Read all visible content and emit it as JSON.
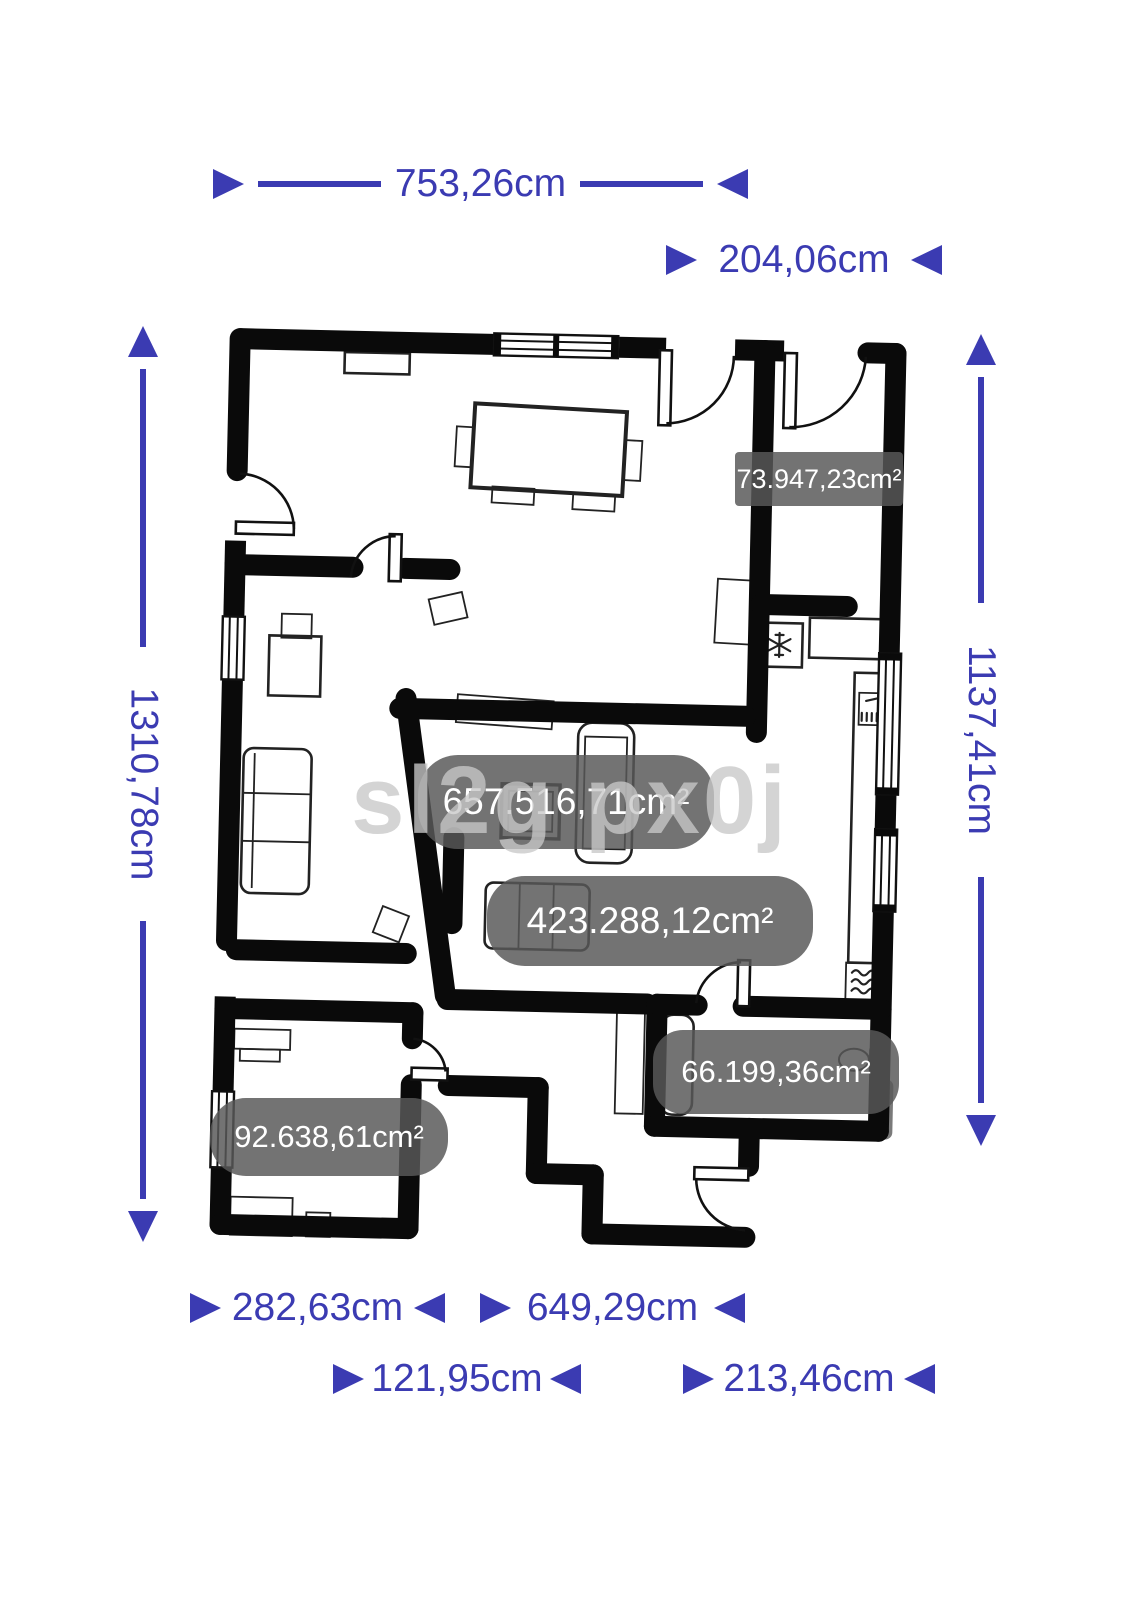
{
  "colors": {
    "dimension_blue": "#3B3BB2",
    "wall_black": "#0A0A0A",
    "badge_bg": "#585858",
    "badge_text": "#FFFFFF",
    "watermark_gray": "#C8C8C8"
  },
  "dims": {
    "top_total": {
      "label": "753,26cm"
    },
    "top_right": {
      "label": "204,06cm"
    },
    "left_total": {
      "label": "1310,78cm"
    },
    "right_side": {
      "label": "1137,41cm"
    },
    "bottom_left": {
      "label": "282,63cm"
    },
    "bottom_center": {
      "label": "649,29cm"
    },
    "bottom2_left": {
      "label": "121,95cm"
    },
    "bottom2_right": {
      "label": "213,46cm"
    }
  },
  "areas": {
    "hallway": {
      "label": "73.947,23cm²"
    },
    "living": {
      "label": "657.516,71cm²"
    },
    "family": {
      "label": "423.288,12cm²"
    },
    "bathroom": {
      "label": "66.199,36cm²"
    },
    "bedroom": {
      "label": "92.638,61cm²"
    }
  },
  "watermark": {
    "text": "sl2g px0j"
  },
  "icons": [
    "snowflake-icon",
    "sink-icon",
    "stove-waves-icon",
    "toilet-icon",
    "bathtub",
    "radiator"
  ]
}
